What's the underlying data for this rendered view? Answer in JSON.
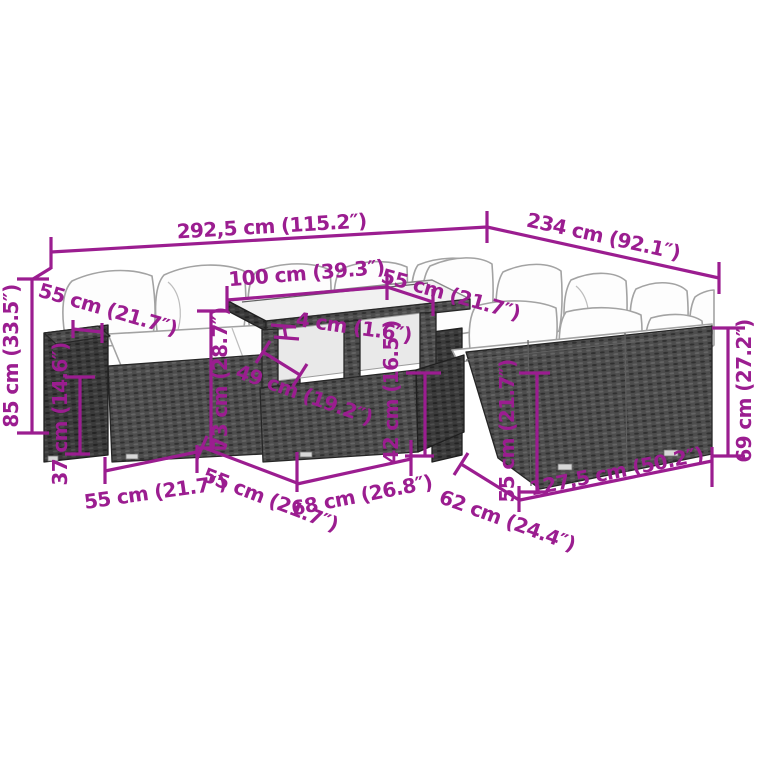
{
  "diagram": {
    "colors": {
      "accent": "#9B1D90",
      "rattan": "#4d4d4d",
      "cushion": "#fdfdfd"
    },
    "dims": [
      {
        "id": "overall-width",
        "label": "292,5 cm (115.2″)"
      },
      {
        "id": "overall-depth",
        "label": "234 cm (92.1″)"
      },
      {
        "id": "table-length",
        "label": "100 cm (39.3″)"
      },
      {
        "id": "back-seat-depth",
        "label": "55 cm (21.7″)"
      },
      {
        "id": "tabletop-thickness",
        "label": "4 cm (1.6″)"
      },
      {
        "id": "total-height",
        "label": "85 cm (33.5″)"
      },
      {
        "id": "armrest-depth",
        "label": "55 cm (21.7″)"
      },
      {
        "id": "seat-height",
        "label": "37 cm (14.6″)"
      },
      {
        "id": "table-height",
        "label": "73 cm (28.7″)"
      },
      {
        "id": "table-depth",
        "label": "49 cm (19.2″)"
      },
      {
        "id": "shelf-height",
        "label": "42 cm (16.5″)"
      },
      {
        "id": "seat-width-left",
        "label": "55 cm (21.7″)"
      },
      {
        "id": "seat-depth-left",
        "label": "55 cm (21.7″)"
      },
      {
        "id": "table-front-width",
        "label": "68 cm (26.8″)"
      },
      {
        "id": "right-sofa-depth",
        "label": "62 cm (24.4″)"
      },
      {
        "id": "right-sofa-width",
        "label": "127,5 cm (50.2″)"
      },
      {
        "id": "right-backrest-height",
        "label": "55 cm (21.7″)"
      },
      {
        "id": "right-side-height",
        "label": "69 cm (27.2″)"
      }
    ]
  }
}
